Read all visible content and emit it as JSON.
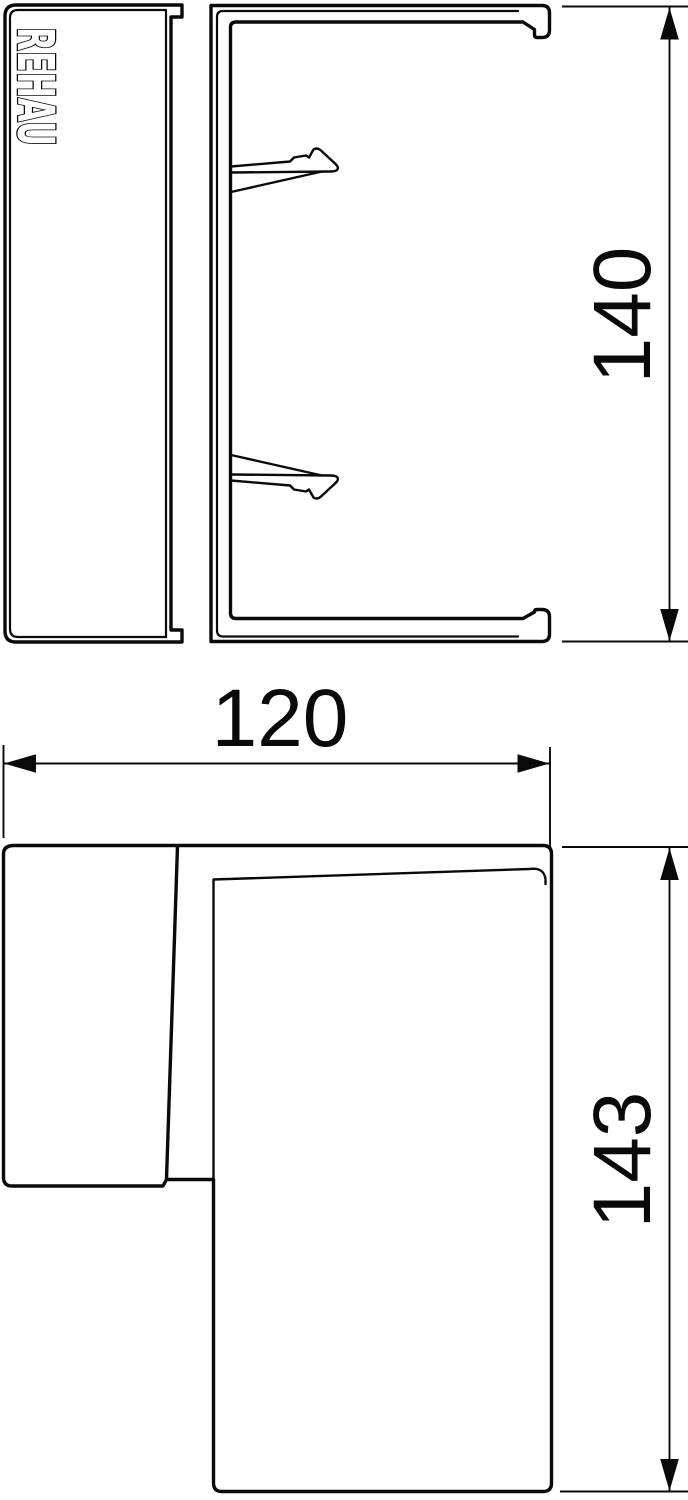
{
  "drawing": {
    "type": "technical-drawing",
    "brand_logo": "REHAU",
    "background_color": "#ffffff",
    "line_color": "#0a0a0a",
    "views": {
      "side_section_view": {
        "description": "side section of corner piece with cover and clip latches",
        "dimension_height": "140"
      },
      "plan_view": {
        "description": "top view of internal corner piece",
        "dimension_width": "120",
        "dimension_height": "143"
      }
    }
  }
}
